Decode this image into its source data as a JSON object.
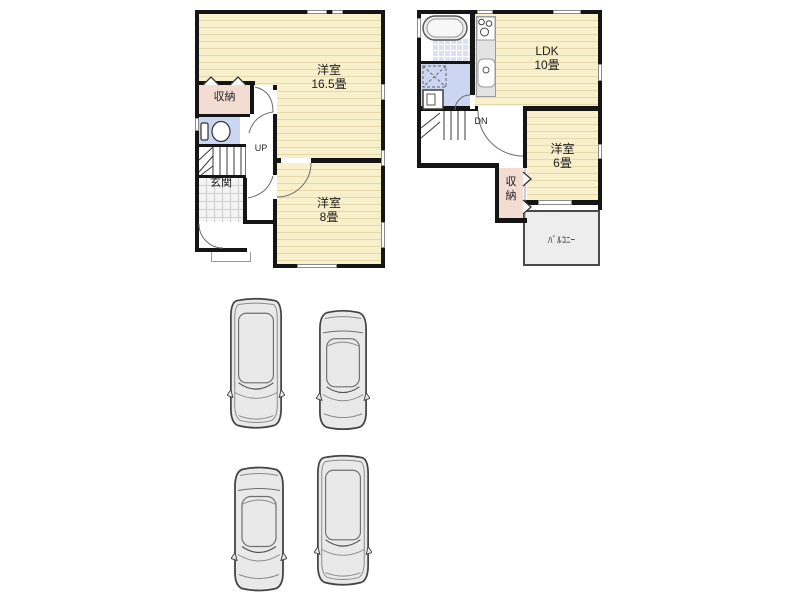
{
  "floor1": {
    "room_large_name": "洋室",
    "room_large_size": "16.5畳",
    "room_small_name": "洋室",
    "room_small_size": "8畳",
    "closet_label": "収納",
    "entrance_label": "玄関",
    "stairs_label": "UP"
  },
  "floor2": {
    "ldk_name": "LDK",
    "ldk_size": "10畳",
    "room_name": "洋室",
    "room_size": "6畳",
    "closet_label": "収納",
    "balcony_label": "ﾊﾞﾙｺﾆｰ",
    "stairs_label": "DN"
  },
  "parking": {
    "cars": [
      "minivan",
      "sedan",
      "sedan",
      "minivan"
    ]
  },
  "colors": {
    "wall": "#151515",
    "room_floor": "#F8EFCB",
    "room_floor_line": "#E4D9AC",
    "closet_fill": "#F3DDD3",
    "wet_area_fill": "#CBD6F2",
    "bath_tile_fill": "#D9E1F6",
    "entrance_tile": "#F4F4F4",
    "balcony_fill": "#EDEDED",
    "car_body": "#E9E9E9"
  }
}
